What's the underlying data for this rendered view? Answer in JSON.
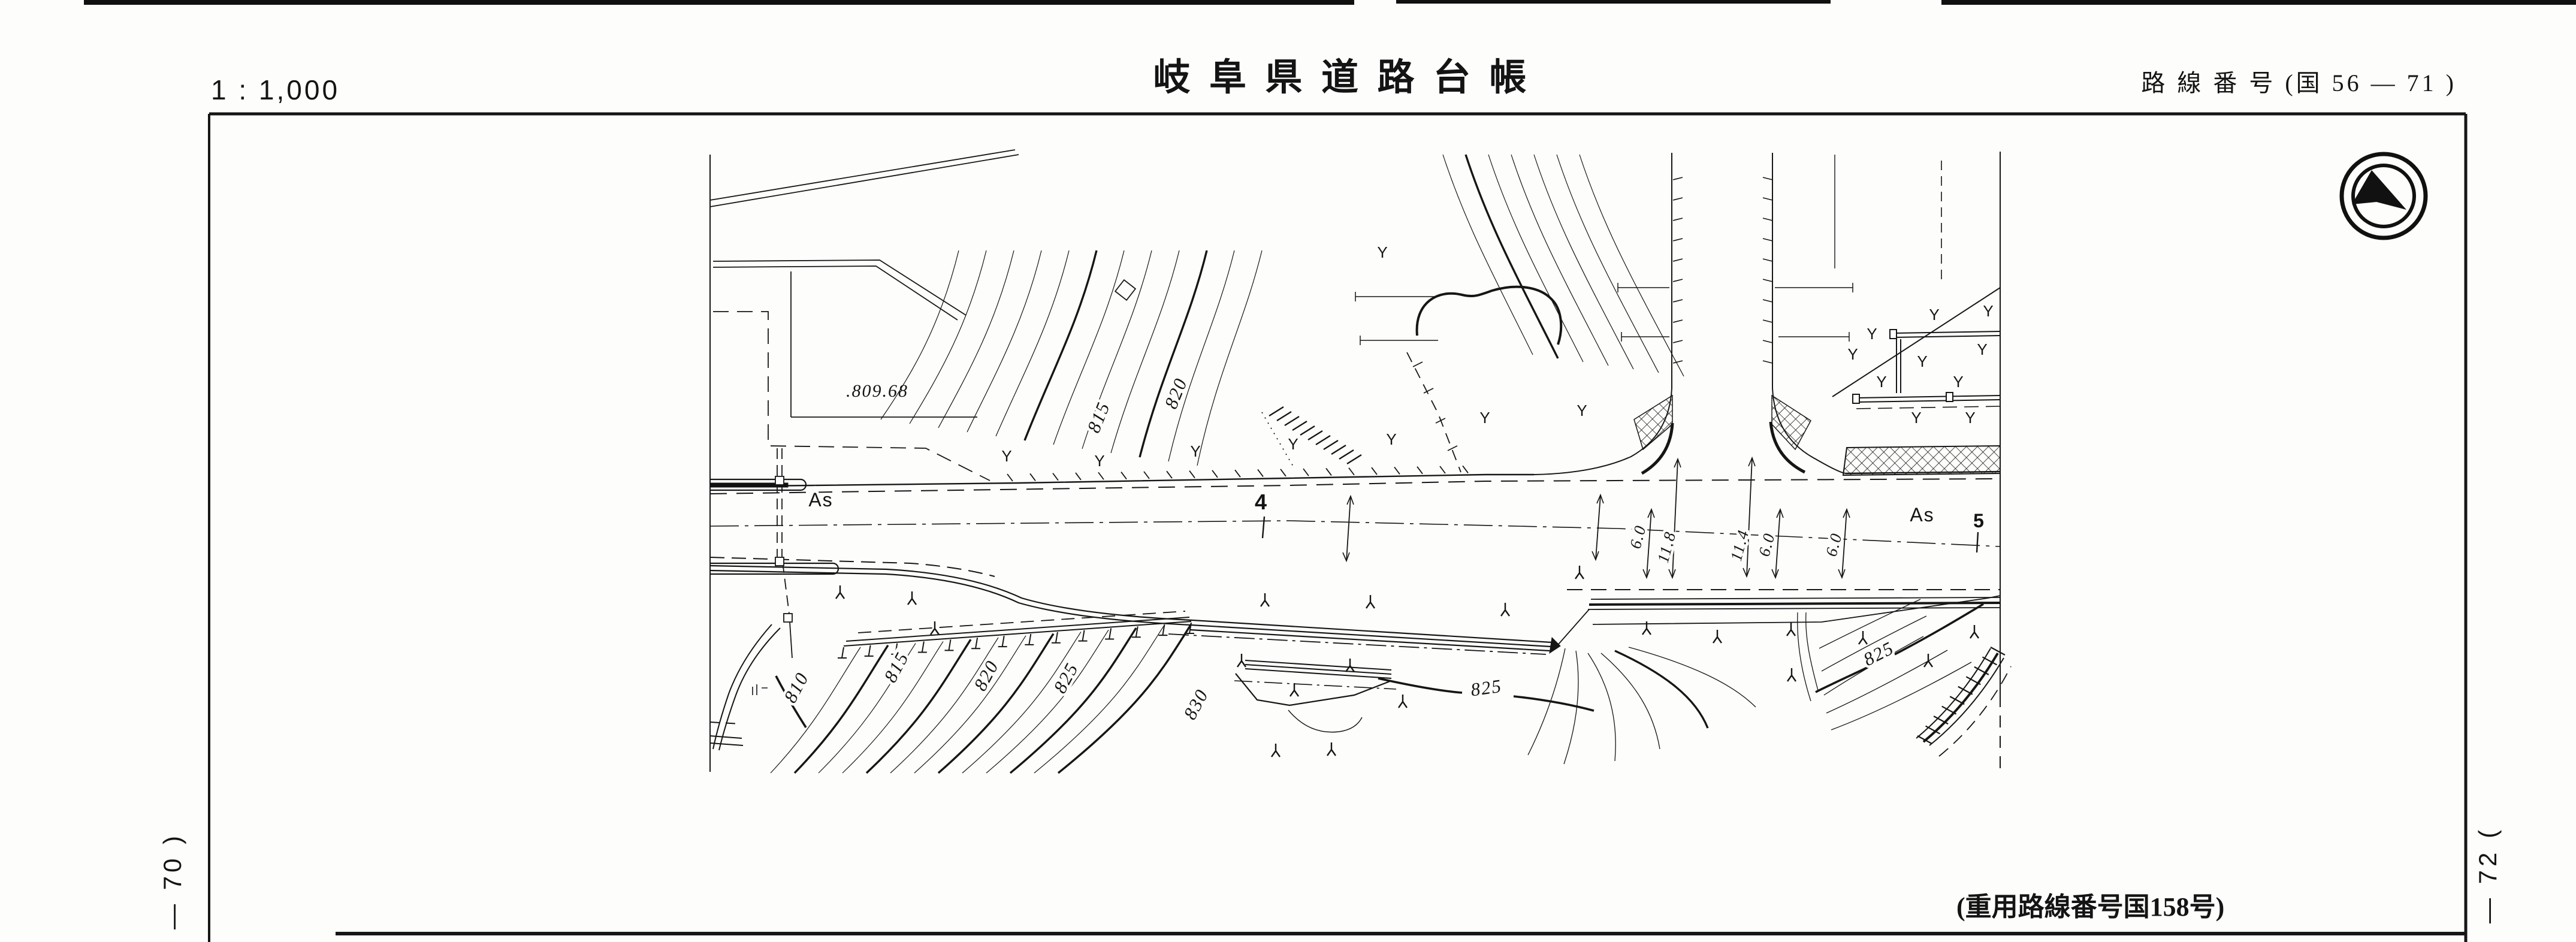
{
  "header": {
    "scale": "1 : 1,000",
    "title": "岐 阜 県 道 路 台 帳",
    "route_label": "路 線 番 号 (国 56 — 71 )"
  },
  "margins": {
    "left_sheet_ref": "— 70 )",
    "right_sheet_ref": "— 72 ("
  },
  "footer": {
    "overlap_note": "(重用路線番号国158号)"
  },
  "compass": {
    "icon": "north-arrow-icon"
  },
  "map": {
    "spot_elevation": ".809.68",
    "stations": [
      "As",
      "4",
      "As",
      "5"
    ],
    "dimension_labels": [
      "6.0",
      "11.8",
      "11.4",
      "6.0",
      "6.0"
    ],
    "contour_labels": {
      "north": [
        "815",
        "820"
      ],
      "south_west": [
        "810",
        "815",
        "820",
        "825",
        "830"
      ],
      "south_mid": "825",
      "south_east": "825"
    },
    "symbols": {
      "vegetation_upper": "Y",
      "vegetation_lower": "inverted-y-brush-mark"
    }
  }
}
